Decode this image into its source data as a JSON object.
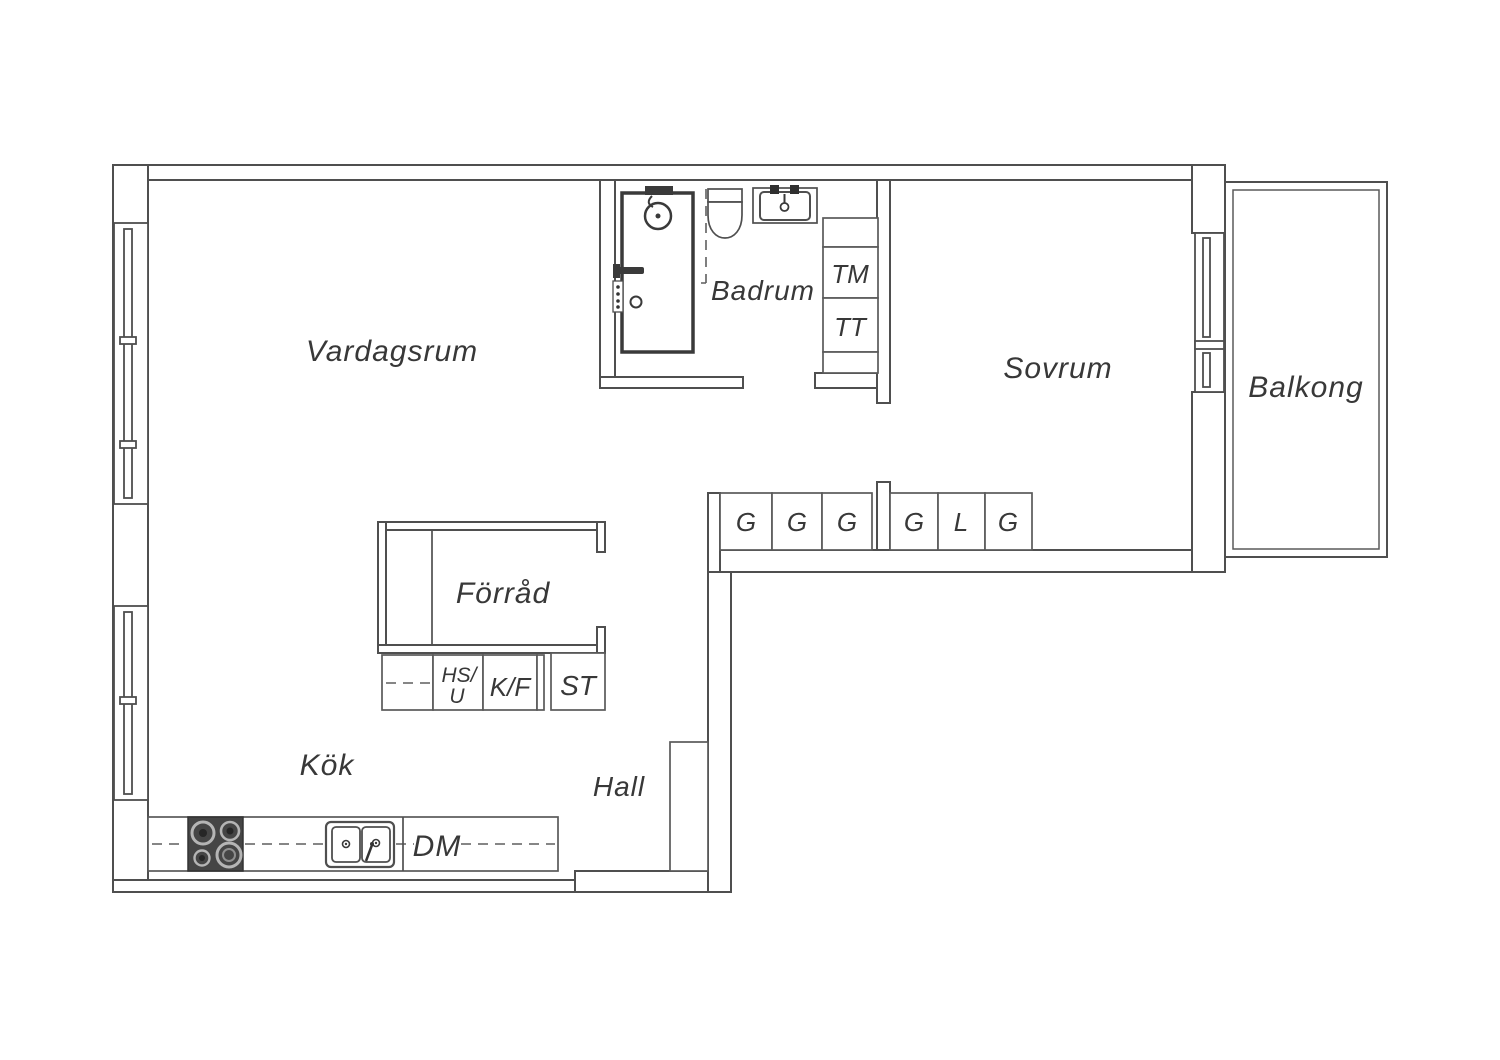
{
  "plan": {
    "rooms": {
      "living": "Vardagsrum",
      "bath": "Badrum",
      "bed": "Sovrum",
      "balcony": "Balkong",
      "storage": "Förråd",
      "kitchen": "Kök",
      "hall": "Hall"
    },
    "units": {
      "washer": "TM",
      "dryer": "TT",
      "dishwasher": "DM",
      "fridge_freezer": "K/F",
      "hs_line1": "HS/",
      "hs_line2": "U",
      "cleaning": "ST"
    },
    "closets": [
      "G",
      "G",
      "G",
      "G",
      "L",
      "G"
    ],
    "colors": {
      "line": "#4f4f4f",
      "fixture_dark": "#3a3a3a",
      "stove_fill": "#454545",
      "text": "#383838",
      "background": "#ffffff"
    }
  }
}
